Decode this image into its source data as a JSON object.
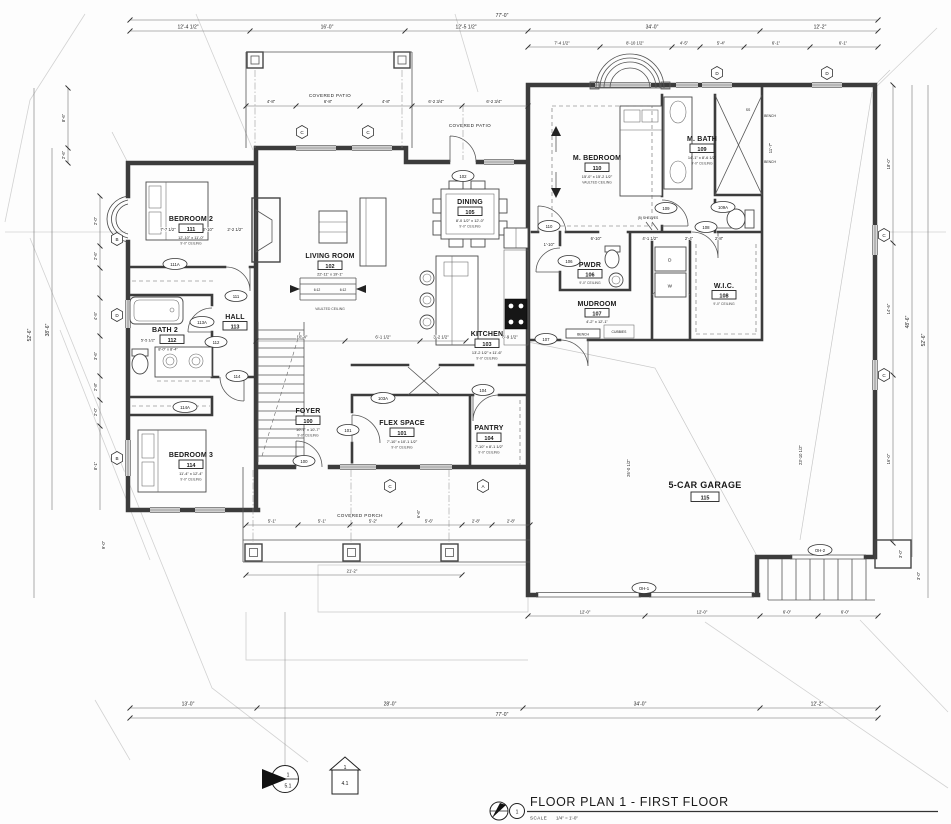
{
  "sheet": {
    "title": "FLOOR PLAN 1 - FIRST FLOOR",
    "scale_label": "SCALE",
    "scale_value": "1/4\" = 1'-0\"",
    "plan_circle_number": "1",
    "section_marker": {
      "number": "1",
      "sheet": "5.1"
    },
    "elevation_marker": {
      "number": "1",
      "sheet": "4.1"
    }
  },
  "rooms": {
    "foyer": {
      "name": "FOYER",
      "number": "100",
      "size": "10'-7\" x 10'-7\"",
      "ceiling": "9'-0\" CEILING"
    },
    "flex": {
      "name": "FLEX SPACE",
      "number": "101",
      "size": "7'-10\" x 10'-1 1/2\"",
      "ceiling": "9'-0\" CEILING"
    },
    "living": {
      "name": "LIVING ROOM",
      "number": "102",
      "size": "22'-11\" x 19'-1\"",
      "ceiling": "VAULTED CEILING"
    },
    "kitchen": {
      "name": "KITCHEN",
      "number": "103",
      "size": "13'-2 1/2\" x 11'-6\"",
      "ceiling": "9'-0\" CEILING"
    },
    "pantry": {
      "name": "PANTRY",
      "number": "104",
      "size": "7'-10\" x 8'-1 1/2\"",
      "ceiling": "9'-0\" CEILING"
    },
    "dining": {
      "name": "DINING",
      "number": "105",
      "size": "8'-0 1/2\" x 12'-0\"",
      "ceiling": "9'-0\" CEILING"
    },
    "pwdr": {
      "name": "PWDR",
      "number": "106",
      "ceiling": "9'-0\" CEILING"
    },
    "mudroom": {
      "name": "MUDROOM",
      "number": "107",
      "size": "4'-2\" x 12'-1\""
    },
    "wic": {
      "name": "W.I.C.",
      "number": "108",
      "ceiling": "9'-0\" CEILING"
    },
    "mbath": {
      "name": "M. BATH",
      "number": "109",
      "size": "14'-1\" x 8'-6 1/2\"",
      "ceiling": "9'-0\" CEILING"
    },
    "mbedroom": {
      "name": "M. BEDROOM",
      "number": "110",
      "size": "15'-0\" x 15'-2 1/2\"",
      "ceiling": "VAULTED CEILING"
    },
    "bedroom2": {
      "name": "BEDROOM 2",
      "number": "111",
      "size": "12'-10\" x 11'-0\"",
      "ceiling": "9'-0\" CEILING"
    },
    "bath2": {
      "name": "BATH 2",
      "number": "112",
      "size": "8'-0\" x 8'-4\"",
      "prefix": "5'-5 1/2\""
    },
    "hall": {
      "name": "HALL",
      "number": "113"
    },
    "bedroom3": {
      "name": "BEDROOM 3",
      "number": "114",
      "size": "11'-4\" x 12'-4\"",
      "ceiling": "9'-0\" CEILING"
    },
    "garage": {
      "name": "5-CAR GARAGE",
      "number": "115"
    }
  },
  "annotations": {
    "covered_patio": "COVERED PATIO",
    "covered_porch": "COVERED PORCH",
    "bench": "BENCH",
    "cubbies": "CUBBIES",
    "shelves": "(5) SHELVES",
    "ss": "SS",
    "washer": "W",
    "dryer": "D",
    "slope": "6:12"
  },
  "door_tags": {
    "d100": "100",
    "d101": "101",
    "d102": "102",
    "d103a": "103A",
    "d104": "104",
    "d106": "106",
    "d107": "107",
    "d108": "108",
    "d109": "109",
    "d109a": "109A",
    "d110": "110",
    "d111": "111",
    "d111a": "111A",
    "d112": "112",
    "d113a": "113A",
    "d114": "114",
    "d114a": "114A",
    "oh1": "OH-1",
    "oh2": "OH-2"
  },
  "window_tags": {
    "a": "A",
    "b": "B",
    "c": "C",
    "d": "D"
  },
  "dims": {
    "top": [
      "77'-0\"",
      "12'-4 1/2\"",
      "16'-0\"",
      "12'-5 1/2\"",
      "34'-0\"",
      "12'-2\"",
      "7'-4 1/2\"",
      "8'-10 1/2\"",
      "4'-5\"",
      "5'-4\"",
      "6'-1\"",
      "6'-1\"",
      "4'-8\"",
      "6'-8\"",
      "4'-8\"",
      "6'-2 3/4\"",
      "6'-2 3/4\""
    ],
    "left": [
      "52'-6\"",
      "38'-6\"",
      "8'-6\"",
      "2'-6\"",
      "2'-0\"",
      "2'-6\"",
      "4'-5\"",
      "3'-6\"",
      "2'-8\"",
      "2'-0\"",
      "8'-1\"",
      "9'-0\""
    ],
    "right": [
      "52'-6\"",
      "48'-6\"",
      "18'-0\"",
      "14'-6\"",
      "16'-0\"",
      "11'-7\"",
      "23'-10 1/2\"",
      "26'-0 1/2\"",
      "3'-0\"",
      "3'-0\""
    ],
    "bottom": [
      "77'-0\"",
      "13'-0\"",
      "28'-0\"",
      "34'-0\"",
      "12'-2\"",
      "12'-0\"",
      "12'-0\"",
      "6'-0\"",
      "6'-0\"",
      "21'-2\"",
      "5'-1\"",
      "5'-1\"",
      "5'-2\"",
      "5'-6\"",
      "2'-8\"",
      "2'-8\""
    ],
    "interior": [
      "10'-4\"",
      "6'-1 1/2\"",
      "3'-2 1/2\"",
      "6'-9 1/2\"",
      "7'-7 1/2\"",
      "2'-2 1/2\"",
      "2'-10\"",
      "6'-10\"",
      "4'-1 1/2\"",
      "2'-4\"",
      "2'-8\"",
      "1'-10\"",
      "6'-6\""
    ]
  }
}
